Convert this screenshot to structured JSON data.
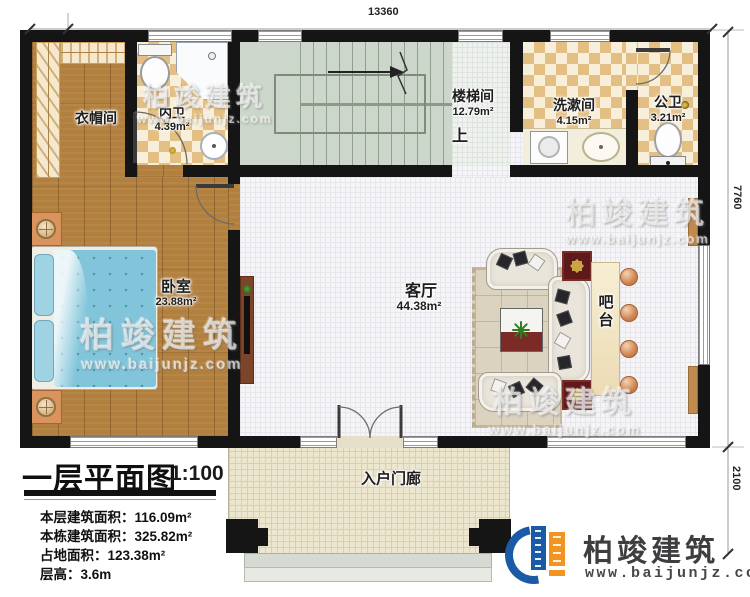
{
  "dimensions": {
    "top": "13360",
    "right_upper": "7760",
    "right_lower": "2100"
  },
  "rooms": {
    "cloakroom": {
      "name": "衣帽间"
    },
    "inner_bath": {
      "name": "内卫",
      "area": "4.39m²"
    },
    "stairwell": {
      "name": "楼梯间",
      "area": "12.79m²",
      "direction": "上"
    },
    "washroom": {
      "name": "洗漱间",
      "area": "4.15m²"
    },
    "public_bath": {
      "name": "公卫",
      "area": "3.21m²"
    },
    "bedroom": {
      "name": "卧室",
      "area": "23.88m²"
    },
    "living_room": {
      "name": "客厅",
      "area": "44.38m²"
    },
    "bar": {
      "name": "吧台"
    },
    "porch": {
      "name": "入户门廊"
    }
  },
  "title_block": {
    "title": "一层平面图",
    "scale": "1:100",
    "stats": [
      {
        "label": "本层建筑面积：",
        "value": "116.09m²"
      },
      {
        "label": "本栋建筑面积：",
        "value": "325.82m²"
      },
      {
        "label": "占地面积：",
        "value": "123.38m²"
      },
      {
        "label": "层高：",
        "value": "3.6m"
      }
    ]
  },
  "watermark": {
    "brand": "柏竣建筑",
    "url": "www.baijunjz.com"
  },
  "logo": {
    "brand": "柏竣建筑",
    "url": "www.baijunjz.com"
  },
  "colors": {
    "wall": "#151515",
    "wood": "#b2803e",
    "tile_checker": "#e4bf83",
    "stair": "#ccd6ca",
    "porch": "#ece6cf",
    "logo_blue": "#1b5aa5",
    "logo_orange": "#f29421"
  }
}
